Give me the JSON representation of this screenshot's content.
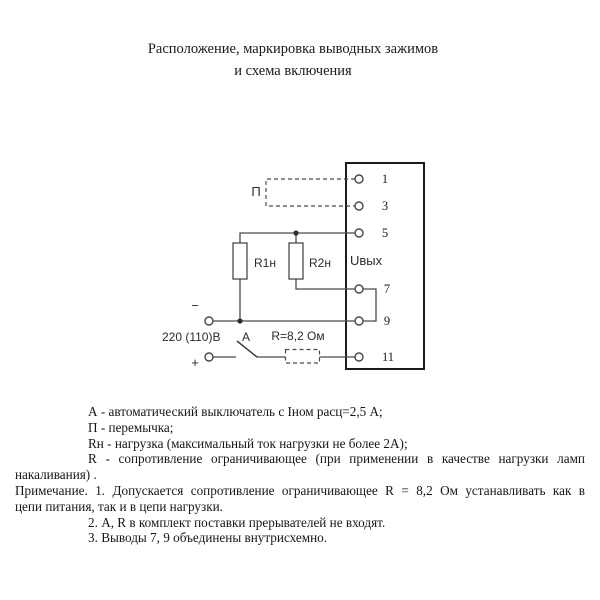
{
  "title": {
    "line1": "Расположение, маркировка выводных зажимов",
    "line2": "и схема включения"
  },
  "diagram": {
    "device": {
      "output_label": "Uвых",
      "terminals": [
        "1",
        "3",
        "5",
        "7",
        "9",
        "11"
      ]
    },
    "labels": {
      "jumper": "П",
      "load1": "R1н",
      "load2": "R2н",
      "supply": "220 (110)В",
      "minus": "−",
      "plus": "+",
      "breaker": "А",
      "limit_resistor": "R=8,2 Ом"
    }
  },
  "notes": {
    "lines": [
      "А -  автоматический выключатель с Iном расц=2,5 А;",
      "П -  перемычка;",
      "Rн - нагрузка  (максимальный ток нагрузки не более 2А);",
      "R -  сопротивление ограничивающее (при применении в качестве нагрузки ламп",
      "накаливания) .",
      "Примечание. 1. Допускается сопротивление ограничивающее R = 8,2 Ом устанавливать как в",
      "цепи питания, так и в цепи нагрузки.",
      "2. А, R в комплект поставки прерывателей не входят.",
      "3. Выводы 7, 9 объединены внутрисхемно."
    ]
  },
  "colors": {
    "ink": "#1c1c1c",
    "line": "#4a4a4a",
    "background": "#ffffff"
  }
}
